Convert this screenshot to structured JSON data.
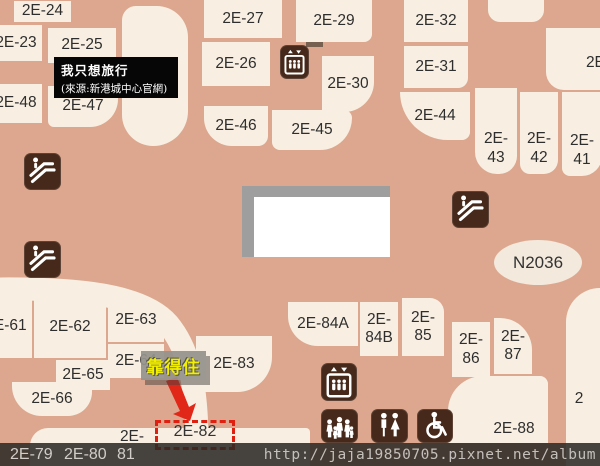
{
  "map": {
    "title": "mall-floorplan-level-2E",
    "annotation": {
      "line1": "我只想旅行",
      "line2": "(來源:新港城中心官網)"
    },
    "highlight": {
      "label": "靠得住",
      "target_unit": "2E-82"
    },
    "room_ellipse": {
      "label": "N2036"
    },
    "atrium": {
      "fill": "#FFFFFF",
      "shadow": "#9E9E9E"
    },
    "colors": {
      "corridor": "#DCA78E",
      "unit_fill": "#F8EFE2",
      "unit_text": "#2E2E2E",
      "icon_brown": "#46291A",
      "highlight_red": "#DF1F0F",
      "label_yellow": "#F2EF00",
      "label_gray_bg": "#94928C",
      "strip_dark": "#2C2926",
      "strip_text": "#D2CDC8"
    },
    "units": [
      {
        "label": "2E-24",
        "x": 14,
        "y": 1,
        "w": 57,
        "h": 21
      },
      {
        "label": "2E-23",
        "x": -10,
        "y": 25,
        "w": 52,
        "h": 36
      },
      {
        "label": "2E-25",
        "x": 48,
        "y": 28,
        "w": 68,
        "h": 35
      },
      {
        "label": "2E-48",
        "x": -10,
        "y": 84,
        "w": 52,
        "h": 39
      },
      {
        "label": "2E-47",
        "x": 48,
        "y": 86,
        "w": 70,
        "h": 41,
        "r": "0 0 28px 6px"
      },
      {
        "label": "2E-27",
        "x": 204,
        "y": 0,
        "w": 78,
        "h": 38
      },
      {
        "label": "2E-29",
        "x": 296,
        "y": 0,
        "w": 76,
        "h": 42,
        "r": "0 0 8px 0"
      },
      {
        "label": "2E-26",
        "x": 202,
        "y": 42,
        "w": 68,
        "h": 44
      },
      {
        "label": "2E-30",
        "x": 322,
        "y": 56,
        "w": 52,
        "h": 56,
        "r": "0 0 30px 0"
      },
      {
        "label": "2E-46",
        "x": 204,
        "y": 106,
        "w": 64,
        "h": 40,
        "r": "0 0 10px 28px"
      },
      {
        "label": "2E-45",
        "x": 272,
        "y": 110,
        "w": 80,
        "h": 40,
        "r": "0 10px 40px 10px"
      },
      {
        "label": "2E-32",
        "x": 404,
        "y": 0,
        "w": 64,
        "h": 42
      },
      {
        "label": "2E-31",
        "x": 404,
        "y": 46,
        "w": 64,
        "h": 42,
        "r": "0 0 10px 0"
      },
      {
        "label": "2E-44",
        "x": 400,
        "y": 92,
        "w": 70,
        "h": 48,
        "r": "0 0 10px 60px"
      },
      {
        "label": "2E-43",
        "lines": [
          "2E-",
          "43"
        ],
        "x": 475,
        "y": 88,
        "w": 42,
        "h": 86,
        "va": "end",
        "r": "0 0 18px 22px"
      },
      {
        "label": "2E-42",
        "lines": [
          "2E-",
          "42"
        ],
        "x": 520,
        "y": 92,
        "w": 38,
        "h": 82,
        "va": "end",
        "r": "0 0 14px 10px"
      },
      {
        "label": "2E-41",
        "lines": [
          "2E-",
          "41"
        ],
        "x": 562,
        "y": 92,
        "w": 40,
        "h": 84,
        "va": "end",
        "r": "0 0 20px 8px"
      },
      {
        "label": "2E-",
        "x": 578,
        "y": 52,
        "w": 40,
        "h": 22,
        "nobg": true
      },
      {
        "label": "2E-61",
        "x": -20,
        "y": 294,
        "w": 52,
        "h": 64
      },
      {
        "label": "2E-62",
        "x": 34,
        "y": 296,
        "w": 72,
        "h": 62
      },
      {
        "label": "2E-63",
        "x": 108,
        "y": 298,
        "w": 56,
        "h": 44,
        "r": "0 30px 0 0"
      },
      {
        "label": "2E-64",
        "x": 108,
        "y": 344,
        "w": 56,
        "h": 34
      },
      {
        "label": "2E-65",
        "x": 56,
        "y": 360,
        "w": 54,
        "h": 30
      },
      {
        "label": "2E-66",
        "x": 12,
        "y": 382,
        "w": 80,
        "h": 34,
        "r": "0 0 24px 30px"
      },
      {
        "label": "2E-83",
        "x": 196,
        "y": 336,
        "w": 76,
        "h": 56,
        "r": "0 0 35px 0"
      },
      {
        "label": "2E-84A",
        "x": 288,
        "y": 302,
        "w": 70,
        "h": 44,
        "r": "0 0 0 30px"
      },
      {
        "label": "2E-84B",
        "lines": [
          "2E-",
          "84B"
        ],
        "x": 360,
        "y": 302,
        "w": 38,
        "h": 54
      },
      {
        "label": "2E-85",
        "lines": [
          "2E-",
          "85"
        ],
        "x": 402,
        "y": 298,
        "w": 42,
        "h": 58,
        "r": "0 14px 0 0"
      },
      {
        "label": "2E-86",
        "lines": [
          "2E-",
          "86"
        ],
        "x": 452,
        "y": 322,
        "w": 38,
        "h": 55
      },
      {
        "label": "2E-87",
        "lines": [
          "2E-",
          "87"
        ],
        "x": 494,
        "y": 318,
        "w": 38,
        "h": 56,
        "r": "0 32px 0 0"
      },
      {
        "label": "2E-88",
        "x": 478,
        "y": 416,
        "w": 72,
        "h": 26,
        "nobg": true
      },
      {
        "label": "2E-",
        "x": 112,
        "y": 429,
        "w": 40,
        "h": 16,
        "nobg": true
      },
      {
        "label": "2",
        "x": 568,
        "y": 388,
        "w": 22,
        "h": 22,
        "nobg": true
      }
    ],
    "blobs": [
      {
        "x": 122,
        "y": 6,
        "w": 66,
        "h": 140,
        "r": "20px 45px 50px 45px"
      },
      {
        "x": 488,
        "y": 0,
        "w": 56,
        "h": 22,
        "r": "0 0 12px 12px"
      },
      {
        "x": 546,
        "y": 28,
        "w": 54,
        "h": 62,
        "r": "0 0 0 18px"
      },
      {
        "x": 566,
        "y": 288,
        "w": 34,
        "h": 178,
        "r": "45px 0 0 0"
      },
      {
        "x": 448,
        "y": 376,
        "w": 100,
        "h": 67,
        "r": "35px 8px 0 0"
      },
      {
        "x": 30,
        "y": 428,
        "w": 280,
        "h": 38,
        "r": "18px 4px 0 0"
      },
      {
        "x": 306,
        "y": 30,
        "w": 17,
        "h": 17,
        "r": "0",
        "cls": "dark"
      }
    ],
    "icons": [
      {
        "name": "escalator",
        "x": 24,
        "y": 153,
        "w": 37,
        "h": 37
      },
      {
        "name": "escalator",
        "x": 24,
        "y": 241,
        "w": 37,
        "h": 37
      },
      {
        "name": "escalator",
        "x": 452,
        "y": 191,
        "w": 37,
        "h": 37
      },
      {
        "name": "elevator",
        "x": 280,
        "y": 45,
        "w": 29,
        "h": 34
      },
      {
        "name": "elevator",
        "x": 321,
        "y": 363,
        "w": 36,
        "h": 38
      },
      {
        "name": "family-restroom",
        "x": 321,
        "y": 409,
        "w": 37,
        "h": 34
      },
      {
        "name": "restroom",
        "x": 371,
        "y": 409,
        "w": 37,
        "h": 34
      },
      {
        "name": "wheelchair-accessible",
        "x": 417,
        "y": 409,
        "w": 36,
        "h": 34
      }
    ],
    "dashed_unit_label": "2E-82",
    "strip": {
      "labels": [
        {
          "text": "2E-79",
          "x": 10
        },
        {
          "text": "2E-80",
          "x": 64
        },
        {
          "text": "81",
          "x": 117
        }
      ],
      "watermark": "http://jaja19850705.pixnet.net/album"
    }
  }
}
